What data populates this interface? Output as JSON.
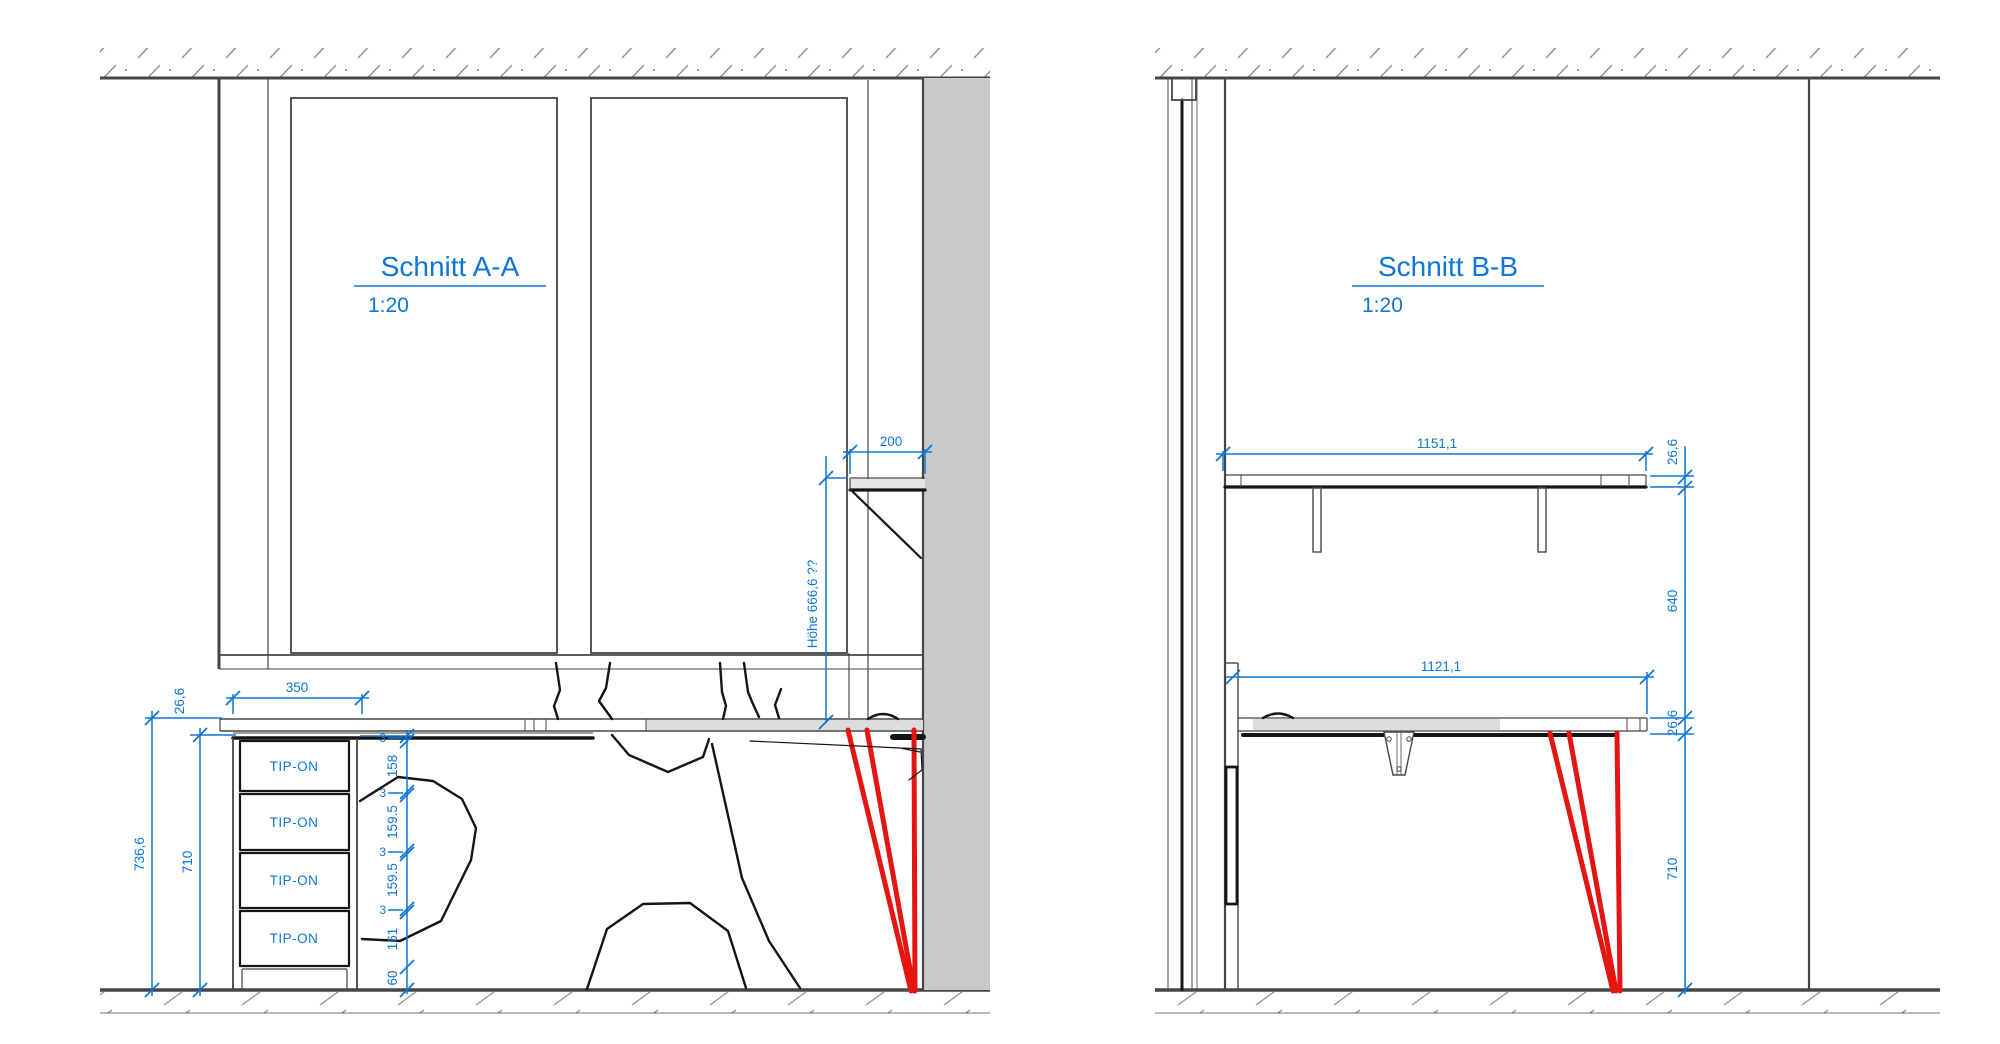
{
  "colors": {
    "annotation_blue": "#0e76d6",
    "leg_red": "#e51511",
    "line_dark": "#464646",
    "wall_gray": "#c9c9c9",
    "desk_gray": "#dcdcdc"
  },
  "section_a": {
    "title": "Schnitt A-A",
    "scale_label": "1:20",
    "dim_cabinet_width": "350",
    "dim_top_thickness": "26,6",
    "dim_total_height": "736,6",
    "dim_clear_height": "710",
    "dim_shelf_depth": "200",
    "dim_shelf_height_note": "Höhe 666,6 ??",
    "gap_labels": [
      "3",
      "3",
      "3",
      "3"
    ],
    "dim_drawer_1": "158",
    "dim_drawer_2": "159.5",
    "dim_drawer_3": "159.5",
    "dim_drawer_4": "161",
    "dim_plinth": "60",
    "drawer_labels": [
      "TIP-ON",
      "TIP-ON",
      "TIP-ON",
      "TIP-ON"
    ]
  },
  "section_b": {
    "title": "Schnitt B-B",
    "scale_label": "1:20",
    "dim_shelf_width": "1151,1",
    "dim_desk_width": "1121,1",
    "dim_shelf_thickness": "26,6",
    "dim_shelf_clearance": "640",
    "dim_desk_thickness": "26,6",
    "dim_desk_height": "710"
  }
}
